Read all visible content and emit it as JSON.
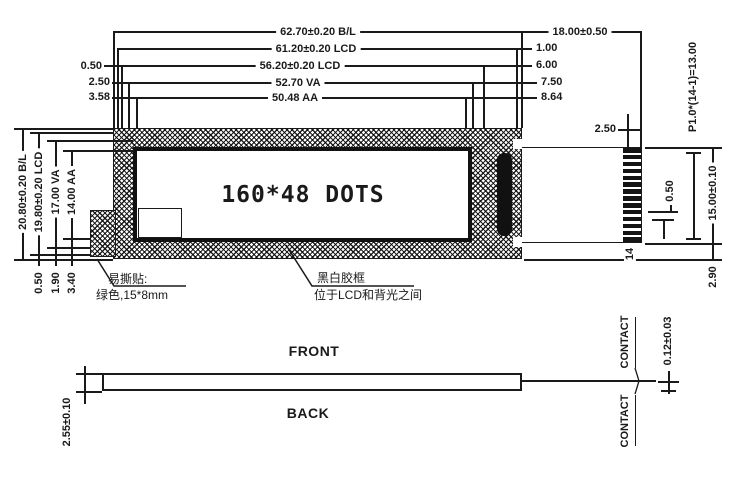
{
  "display": {
    "dots": "160*48 DOTS"
  },
  "dims": {
    "top": {
      "bl": "62.70±0.20 B/L",
      "lcd_outer": "61.20±0.20 LCD",
      "lcd_inner": "56.20±0.20 LCD",
      "va": "52.70 VA",
      "aa": "50.48 AA",
      "tab_width": "18.00±0.50"
    },
    "top_left_offsets": {
      "lcd": "0.50",
      "va": "2.50",
      "aa": "3.58"
    },
    "top_right_offsets": {
      "lcd_outer": "1.00",
      "lcd_inner": "6.00",
      "va": "7.50",
      "aa": "8.64"
    },
    "left": {
      "bl": "20.80±0.20 B/L",
      "lcd": "19.80±0.20 LCD",
      "va": "17.00 VA",
      "aa": "14.00 AA"
    },
    "bottom_left_offsets": {
      "lcd": "0.50",
      "va": "1.90",
      "aa": "3.40"
    },
    "right": {
      "tab_top_offset": "2.50",
      "pin_pitch": "P1.0*(14-1)=13.00",
      "tab_height": "15.00±0.10",
      "pin_gap": "0.50",
      "pin_count_label": "14",
      "tab_bottom_offset": "2.90"
    }
  },
  "notes": {
    "sticker1": "易撕贴:",
    "sticker2": "绿色,15*8mm",
    "bezel1": "黑白胶框",
    "bezel2": "位于LCD和背光之间"
  },
  "side_view": {
    "front": "FRONT",
    "back": "BACK",
    "thickness": "2.55±0.10",
    "contact_top": "CONTACT",
    "contact_bottom": "CONTACT",
    "contact_thickness": "0.12±0.03"
  },
  "pins": {
    "count": 14
  },
  "colors": {
    "line": "#1a1a1a",
    "bg": "#ffffff"
  }
}
